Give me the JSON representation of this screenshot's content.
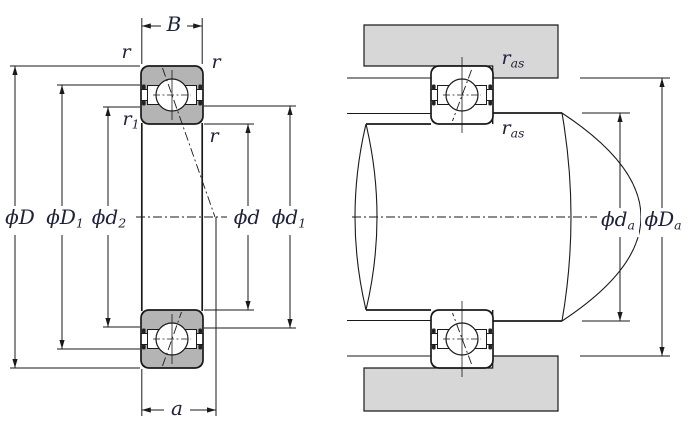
{
  "colors": {
    "background": "#ffffff",
    "line": "#1a1a1a",
    "ring_fill": "#b4b4b4",
    "housing_fill": "#d7d7d7",
    "label_text": "#1e2138"
  },
  "left": {
    "labels": {
      "B": {
        "text": "B",
        "sub": ""
      },
      "r_top_left": {
        "text": "r",
        "sub": ""
      },
      "r_top_right": {
        "text": "r",
        "sub": ""
      },
      "r_mid_right": {
        "text": "r",
        "sub": ""
      },
      "r1": {
        "text": "r",
        "sub": "1"
      },
      "phi_D": {
        "text": "ϕD",
        "sub": ""
      },
      "phi_D1": {
        "text": "ϕD",
        "sub": "1"
      },
      "phi_d2": {
        "text": "ϕd",
        "sub": "2"
      },
      "phi_d": {
        "text": "ϕd",
        "sub": ""
      },
      "phi_d1": {
        "text": "ϕd",
        "sub": "1"
      },
      "a": {
        "text": "a",
        "sub": ""
      }
    }
  },
  "right": {
    "labels": {
      "r_as_top": {
        "text": "r",
        "sub": "as"
      },
      "r_as_bottom": {
        "text": "r",
        "sub": "as"
      },
      "phi_da": {
        "text": "ϕd",
        "sub": "a"
      },
      "phi_Da": {
        "text": "ϕD",
        "sub": "a"
      }
    }
  }
}
